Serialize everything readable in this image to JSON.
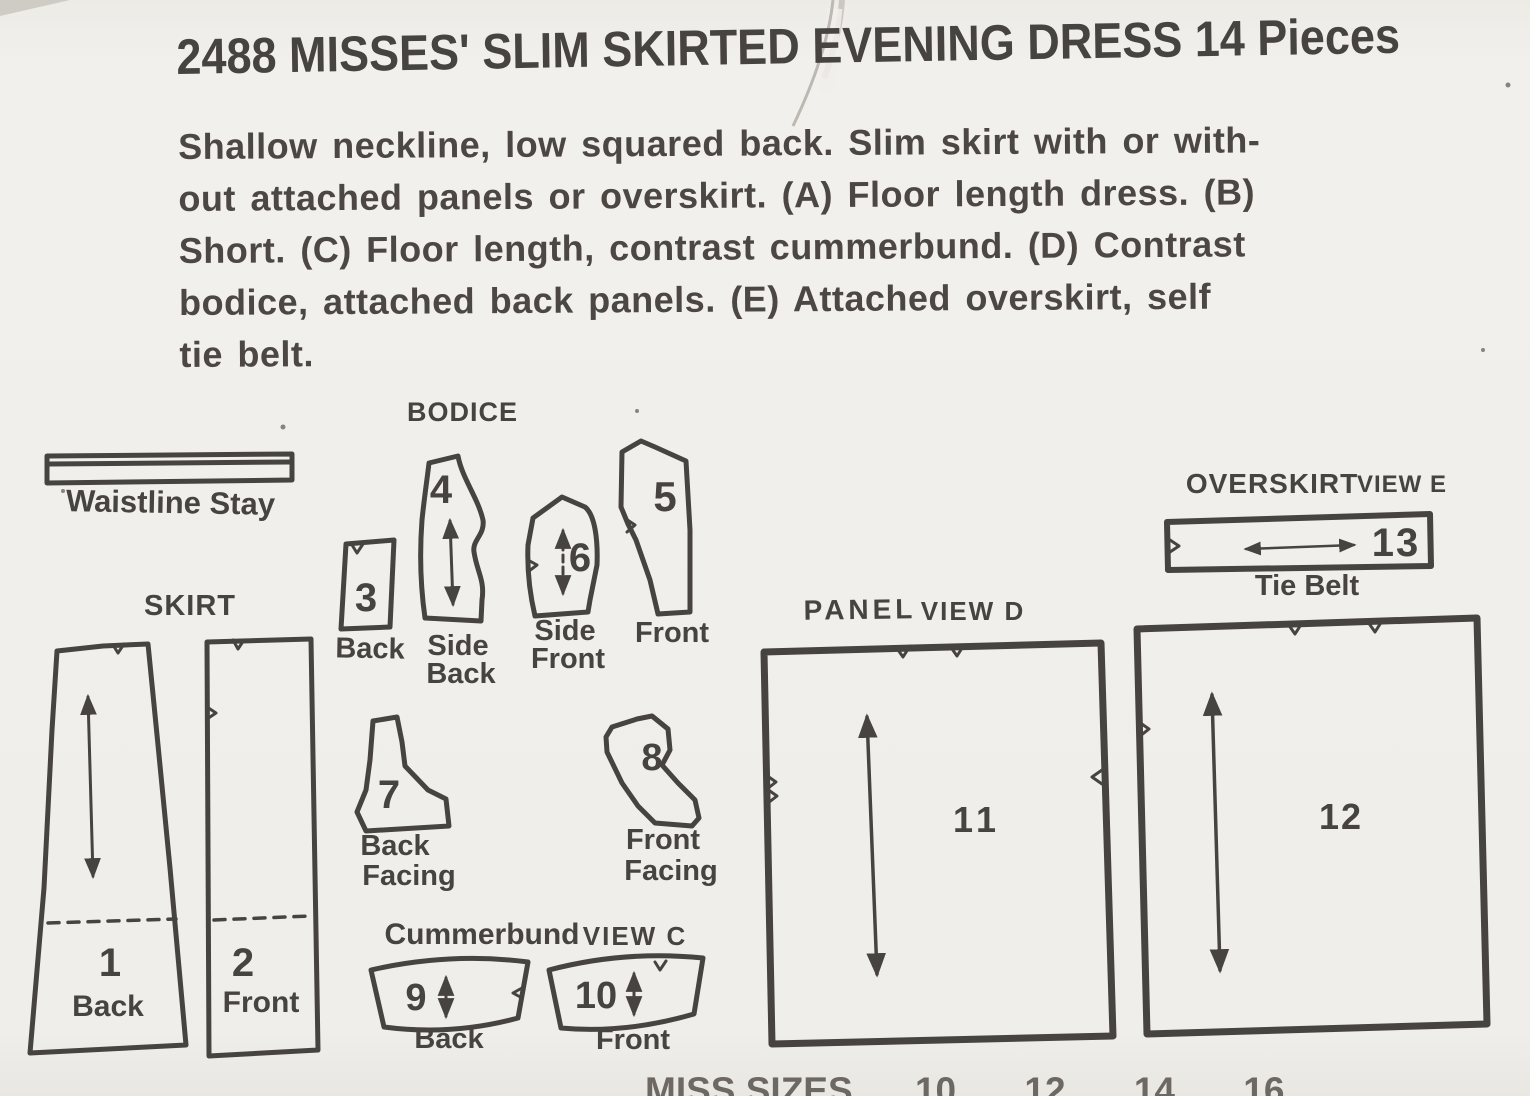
{
  "title": "2488 MISSES' SLIM SKIRTED EVENING DRESS 14 Pieces",
  "description_lines": [
    "Shallow neckline, low squared back. Slim skirt with or with-",
    "out attached panels or overskirt. (A) Floor length dress. (B)",
    "Short. (C) Floor length, contrast cummerbund. (D) Contrast",
    "bodice, attached back panels. (E) Attached overskirt, self",
    "tie belt."
  ],
  "headings": {
    "bodice": "BODICE",
    "skirt": "SKIRT",
    "waistline_stay": "Waistline Stay",
    "cummerbund": "Cummerbund",
    "cummerbund_view": "VIEW C",
    "panel": "PANEL",
    "panel_view": "VIEW D",
    "overskirt": "OVERSKIRT",
    "overskirt_view": "VIEW E"
  },
  "pieces": {
    "p1": {
      "number": "1",
      "label": "Back"
    },
    "p2": {
      "number": "2",
      "label": "Front"
    },
    "p3": {
      "number": "3",
      "label": "Back"
    },
    "p4": {
      "number": "4",
      "label_line1": "Side",
      "label_line2": "Back"
    },
    "p5": {
      "number": "5",
      "label": "Front"
    },
    "p6": {
      "number": "6",
      "label_line1": "Side",
      "label_line2": "Front"
    },
    "p7": {
      "number": "7",
      "label_line1": "Back",
      "label_line2": "Facing"
    },
    "p8": {
      "number": "8",
      "label_line1": "Front",
      "label_line2": "Facing"
    },
    "p9": {
      "number": "9",
      "label": "Back"
    },
    "p10": {
      "number": "10",
      "label": "Front"
    },
    "p11": {
      "number": "11"
    },
    "p12": {
      "number": "12"
    },
    "p13": {
      "number": "13",
      "label": "Tie Belt"
    }
  },
  "footer": {
    "sizes_label": "MISS SIZES",
    "sizes": [
      "10",
      "12",
      "14",
      "16"
    ]
  },
  "colors": {
    "paper": "#f0eeea",
    "ink": "#474340"
  }
}
